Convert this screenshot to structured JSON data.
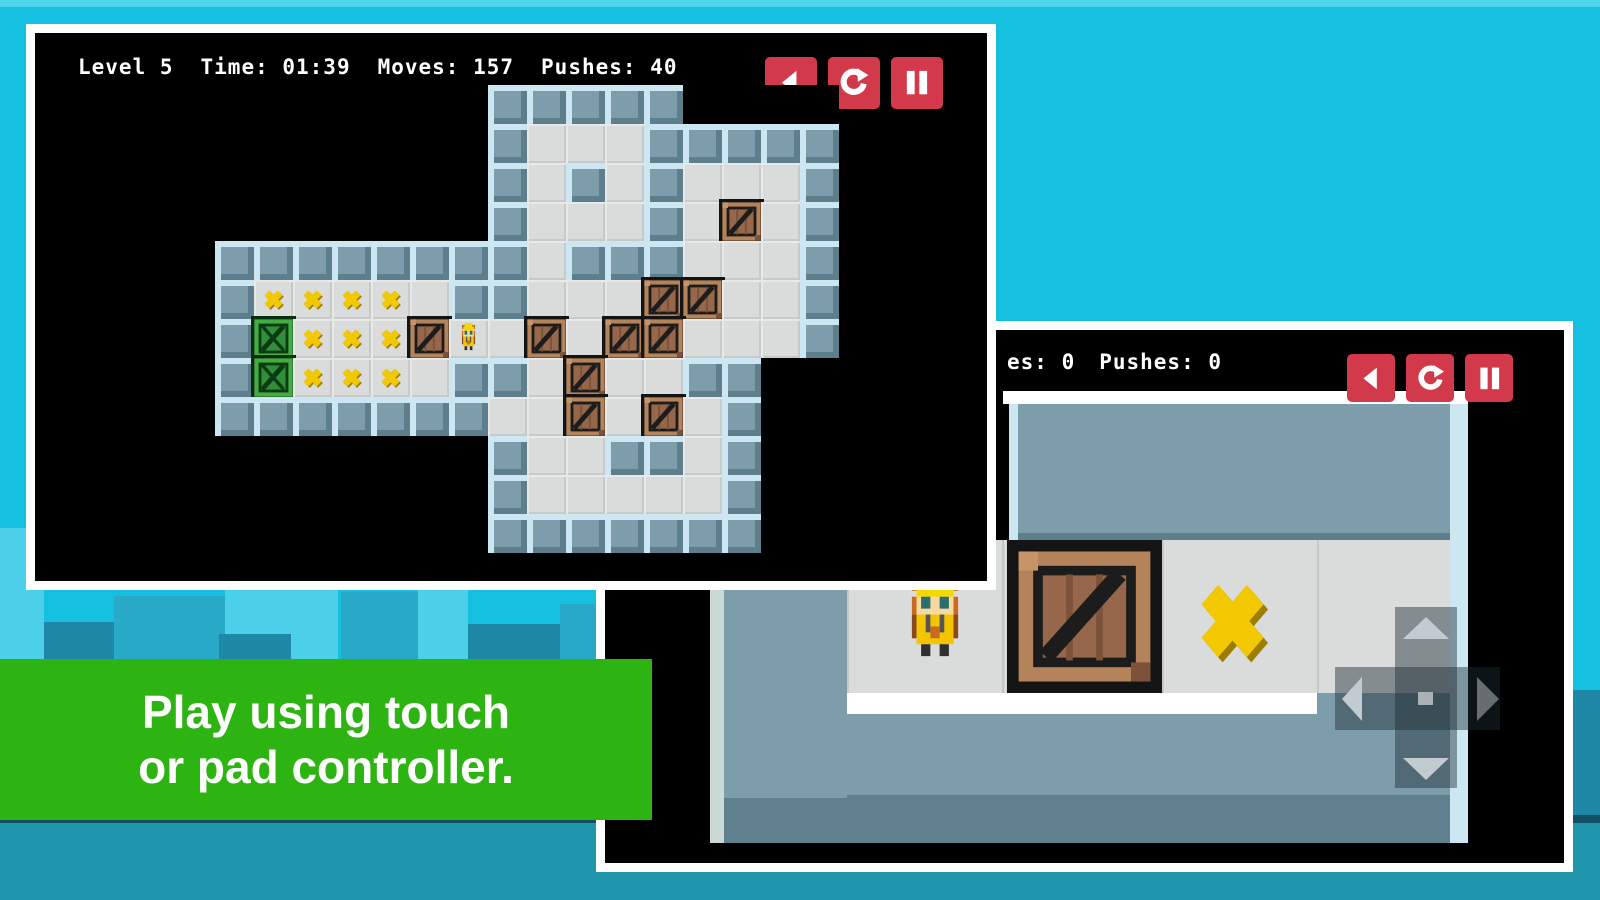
{
  "palette": {
    "background_cyan": "#15bfe0",
    "banner_green": "#2eb412",
    "button_red": "#d23a4b",
    "wall": "#7e9dab",
    "wall_light": "#cde7f2",
    "wall_dark": "#5d7e8c",
    "floor": "#dadbdb",
    "crate_frame": "#b5835a",
    "crate_inner": "#96674a",
    "green_crate_frame": "#43ad43",
    "green_crate_inner": "#2f8f3a",
    "target_yellow": "#f2c800",
    "skyline_light": "#4ccfe8",
    "skyline_mid": "#28a9c8",
    "skyline_dark": "#1e88a6",
    "ground": "#1f96ac"
  },
  "background": {
    "skyline": [
      {
        "x": 0,
        "w": 44,
        "top": 528,
        "shade": "skyline_light"
      },
      {
        "x": 44,
        "w": 70,
        "top": 622,
        "shade": "skyline_dark"
      },
      {
        "x": 114,
        "w": 116,
        "top": 596,
        "shade": "skyline_mid"
      },
      {
        "x": 225,
        "w": 113,
        "top": 586,
        "shade": "skyline_light"
      },
      {
        "x": 219,
        "w": 72,
        "top": 634,
        "shade": "skyline_dark"
      },
      {
        "x": 341,
        "w": 77,
        "top": 592,
        "shade": "skyline_mid"
      },
      {
        "x": 418,
        "w": 50,
        "top": 574,
        "shade": "skyline_light"
      },
      {
        "x": 468,
        "w": 114,
        "top": 624,
        "shade": "skyline_dark"
      },
      {
        "x": 560,
        "w": 40,
        "top": 604,
        "shade": "skyline_mid"
      },
      {
        "x": 1573,
        "w": 27,
        "top": 690,
        "shade": "skyline_dark"
      }
    ]
  },
  "banner": {
    "line1": "Play using touch",
    "line2": "or pad controller."
  },
  "screenshot1": {
    "hud": {
      "level": "Level 5",
      "time": "Time: 01:39",
      "moves": "Moves: 157",
      "pushes": "Pushes: 40"
    },
    "buttons": [
      {
        "name": "back-button",
        "icon": "ic-back"
      },
      {
        "name": "restart-button",
        "icon": "ic-restart"
      },
      {
        "name": "pause-button",
        "icon": "ic-pause"
      }
    ],
    "tile_size": 39,
    "level_map": [
      "       #####    ",
      "       #...#####",
      "       #.#.#...#",
      "       #...#.c.#",
      "########.###...#",
      "#xxxx.##...cc..#",
      "#gxxxcp.c.cc...#",
      "#gxxx.##.c..##  ",
      "#######..c.c.#  ",
      "       #..##.#  ",
      "       #.....#  ",
      "       #######  "
    ],
    "legend": {
      "#": "wall",
      ".": "floor",
      "x": "target",
      "c": "crate",
      "g": "crate-on-target",
      "p": "player",
      " ": "outside"
    }
  },
  "screenshot2": {
    "hud_fragment": {
      "moves_partial": "es: 0",
      "pushes": "Pushes: 0"
    },
    "buttons": [
      {
        "name": "back-button",
        "icon": "ic-back"
      },
      {
        "name": "restart-button",
        "icon": "ic-restart"
      },
      {
        "name": "pause-button",
        "icon": "ic-pause"
      }
    ],
    "scene_sprites": [
      "player",
      "crate",
      "target"
    ],
    "dpad_directions": [
      "up",
      "down",
      "left",
      "right"
    ]
  }
}
